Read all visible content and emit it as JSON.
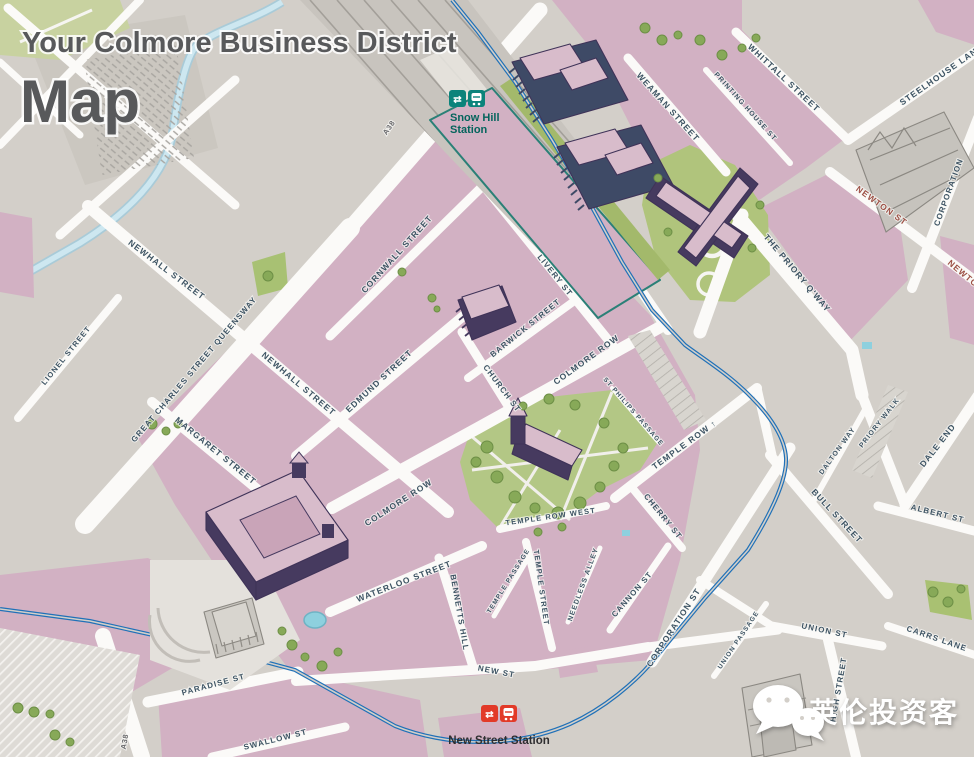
{
  "title": {
    "line1": "Your Colmore Business District",
    "line2": "Map"
  },
  "stations": {
    "snow_hill": {
      "line1": "Snow Hill",
      "line2": "Station"
    },
    "new_street": {
      "name": "New Street Station"
    }
  },
  "watermark": {
    "text": "英伦投资客"
  },
  "colors": {
    "background": "#d3cfc9",
    "block_pink": "#d2b1c3",
    "road_white": "#fbfaf8",
    "park_green": "#b3c785",
    "tram_blue": "#2071b8",
    "canal_blue": "#cde7f0",
    "snow_hill_teal": "#0b837b",
    "new_street_red": "#e23a28",
    "street_text": "#3d5363",
    "street_text_red": "#9c4f44",
    "building_purple": "#463a5f",
    "building_roof_pink": "#d8bccb",
    "title_gray": "#58595b"
  },
  "road_labels": [
    {
      "t": "NEWHALL STREET",
      "x": 165,
      "y": 272,
      "a": 37,
      "s": 8.5
    },
    {
      "t": "LIONEL STREET",
      "x": 68,
      "y": 357,
      "a": -51,
      "s": 7.5
    },
    {
      "t": "GREAT CHARLES STREET QUEENSWAY",
      "x": 196,
      "y": 371,
      "a": -49.5,
      "s": 8
    },
    {
      "t": "NEWHALL STREET",
      "x": 297,
      "y": 386,
      "a": 40,
      "s": 8.5
    },
    {
      "t": "CORNWALL STREET",
      "x": 399,
      "y": 256,
      "a": -48,
      "s": 8.5
    },
    {
      "t": "EDMUND STREET",
      "x": 381,
      "y": 383,
      "a": -43,
      "s": 8.5
    },
    {
      "t": "MARGARET STREET",
      "x": 214,
      "y": 453,
      "a": 39,
      "s": 8.5
    },
    {
      "t": "BARWICK STREET",
      "x": 527,
      "y": 330,
      "a": -39,
      "s": 8
    },
    {
      "t": "CHURCH ST",
      "x": 500,
      "y": 390,
      "a": 53,
      "s": 8
    },
    {
      "t": "LIVERY ST",
      "x": 553,
      "y": 277,
      "a": 51,
      "s": 8
    },
    {
      "t": "COLMORE ROW",
      "x": 588,
      "y": 362,
      "a": -36,
      "s": 8.5
    },
    {
      "t": "COLMORE ROW",
      "x": 400,
      "y": 505,
      "a": -33,
      "s": 8.5
    },
    {
      "t": "ST PHILIPS PASSAGE",
      "x": 632,
      "y": 413,
      "a": 49,
      "s": 6.5
    },
    {
      "t": "TEMPLE ROW ↑",
      "x": 686,
      "y": 447,
      "a": -36,
      "s": 8.5
    },
    {
      "t": "TEMPLE ROW WEST",
      "x": 551,
      "y": 519,
      "a": -8,
      "s": 7.5
    },
    {
      "t": "CHERRY ST",
      "x": 661,
      "y": 518,
      "a": 51,
      "s": 8
    },
    {
      "t": "WATERLOO STREET",
      "x": 405,
      "y": 584,
      "a": -21,
      "s": 8.5
    },
    {
      "t": "BENNETTS HILL",
      "x": 457,
      "y": 613,
      "a": 80,
      "s": 8
    },
    {
      "t": "TEMPLE PASSAGE",
      "x": 510,
      "y": 582,
      "a": -58,
      "s": 6.5
    },
    {
      "t": "TEMPLE STREET",
      "x": 539,
      "y": 588,
      "a": 82,
      "s": 7.5
    },
    {
      "t": "NEEDLESS ALLEY",
      "x": 585,
      "y": 585,
      "a": -70,
      "s": 7
    },
    {
      "t": "CANNON ST",
      "x": 634,
      "y": 596,
      "a": -49,
      "s": 8
    },
    {
      "t": "CORPORATION ST",
      "x": 676,
      "y": 629,
      "a": -57,
      "s": 8.5
    },
    {
      "t": "NEW ST",
      "x": 496,
      "y": 674,
      "a": 11,
      "s": 8
    },
    {
      "t": "UNION PASSAGE",
      "x": 740,
      "y": 641,
      "a": -56,
      "s": 6.5
    },
    {
      "t": "UNION ST",
      "x": 824,
      "y": 633,
      "a": 12,
      "s": 8
    },
    {
      "t": "CARRS LANE",
      "x": 936,
      "y": 641,
      "a": 19,
      "s": 8
    },
    {
      "t": "HIGH STREET",
      "x": 841,
      "y": 690,
      "a": -80,
      "s": 8
    },
    {
      "t": "PARADISE ST",
      "x": 214,
      "y": 687,
      "a": -15,
      "s": 8
    },
    {
      "t": "SWALLOW ST",
      "x": 276,
      "y": 742,
      "a": -14,
      "s": 8
    },
    {
      "t": "WEAMAN STREET",
      "x": 666,
      "y": 109,
      "a": 48,
      "s": 8.5
    },
    {
      "t": "WHITTALL STREET",
      "x": 782,
      "y": 80,
      "a": 43,
      "s": 8.5
    },
    {
      "t": "PRINTING HOUSE ST",
      "x": 744,
      "y": 108,
      "a": 48,
      "s": 7
    },
    {
      "t": "STEELHOUSE LANE",
      "x": 943,
      "y": 77,
      "a": -35,
      "s": 8.5
    },
    {
      "t": "NEWTON ST",
      "x": 880,
      "y": 208,
      "a": 36,
      "s": 8.5,
      "c": "red"
    },
    {
      "t": "NEWTON",
      "x": 964,
      "y": 278,
      "a": 40,
      "s": 8.5,
      "c": "red"
    },
    {
      "t": "CORPORATION",
      "x": 951,
      "y": 193,
      "a": -70,
      "s": 8
    },
    {
      "t": "THE PRIORY Q'WAY",
      "x": 795,
      "y": 275,
      "a": 50,
      "s": 8.5
    },
    {
      "t": "DALTON WAY",
      "x": 839,
      "y": 452,
      "a": -54,
      "s": 7
    },
    {
      "t": "PRIORY WALK",
      "x": 881,
      "y": 424,
      "a": -52,
      "s": 7
    },
    {
      "t": "DALE END",
      "x": 940,
      "y": 447,
      "a": -52,
      "s": 8.5
    },
    {
      "t": "BULL STREET",
      "x": 835,
      "y": 518,
      "a": 47,
      "s": 8.5
    },
    {
      "t": "ALBERT ST",
      "x": 937,
      "y": 516,
      "a": 14,
      "s": 8
    },
    {
      "t": "A38",
      "x": 391,
      "y": 129,
      "a": -55,
      "s": 7.5,
      "c": "gray"
    },
    {
      "t": "A38",
      "x": 127,
      "y": 742,
      "a": -80,
      "s": 7.5,
      "c": "gray"
    }
  ]
}
